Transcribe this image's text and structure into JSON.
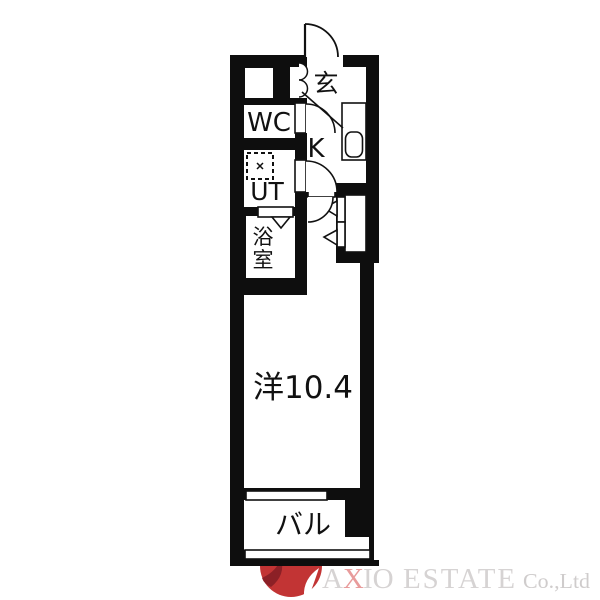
{
  "plan": {
    "rooms": {
      "genkan": "玄",
      "wc": "WC",
      "kitchen": "K",
      "ut": "UT",
      "bath_char1": "浴",
      "bath_char2": "室",
      "main_room": "洋10.4",
      "balcony": "バル"
    },
    "colors": {
      "wall": "#0e0e0e",
      "floor": "#ffffff",
      "line": "#1a1a1a"
    }
  },
  "logo": {
    "brand_prefix": "A",
    "brand_accent": "X",
    "brand_suffix": "IO",
    "brand_word2": "ESTATE",
    "brand_tail": "Co.,Ltd",
    "colors": {
      "text": "#d6d3d3",
      "accent": "#e89b9b",
      "tail": "#cfcccc",
      "mark_red": "#c23434",
      "mark_dark": "#8c2026"
    }
  }
}
